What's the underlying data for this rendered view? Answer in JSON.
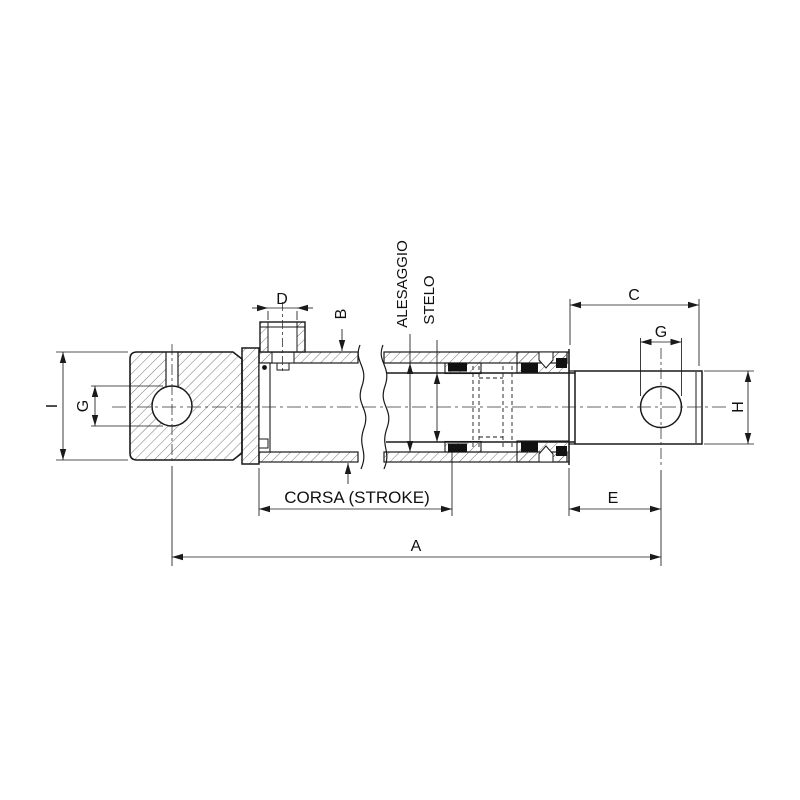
{
  "drawing": {
    "dimensions": {
      "a": "A",
      "b": "B",
      "c": "C",
      "d": "D",
      "e": "E",
      "g_eye_left": "G",
      "g_eye_right": "G",
      "h": "H",
      "i": "I",
      "bore_label": "ALESAGGIO",
      "rod_label": "STELO",
      "stroke_label": "CORSA (STROKE)"
    },
    "colors": {
      "line": "#1a1a1a",
      "background": "#ffffff",
      "seal": "#111111"
    }
  }
}
